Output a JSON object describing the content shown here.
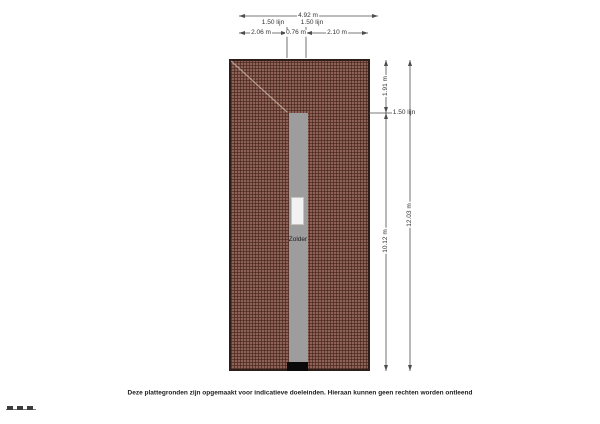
{
  "colors": {
    "roof_base": "#8d6154",
    "roof_grid": "#3e2019",
    "plan_border": "#2e1e19",
    "landing_gray": "#9d9d9d",
    "hatch_white": "#f2f2f2",
    "entry_black": "#0a0a0a",
    "dim_line": "#4d4d4d",
    "dim_text": "#333333"
  },
  "plan": {
    "room_label": "Zolder"
  },
  "dimensions": {
    "top": {
      "total": "4.92 m",
      "left_line": "1.50 lijn",
      "right_line": "1.50 lijn",
      "seg_left": "2.06 m",
      "seg_mid": "0.76 m",
      "seg_right": "2.10 m"
    },
    "right": {
      "upper": "1.91 m",
      "line": "1.50 lijn",
      "lower": "10.12 m",
      "total": "12.03 m"
    }
  },
  "footer": {
    "disclaimer": "Deze plattegronden zijn opgemaakt voor indicatieve doeleinden. Hieraan kunnen geen rechten worden ontleend"
  }
}
